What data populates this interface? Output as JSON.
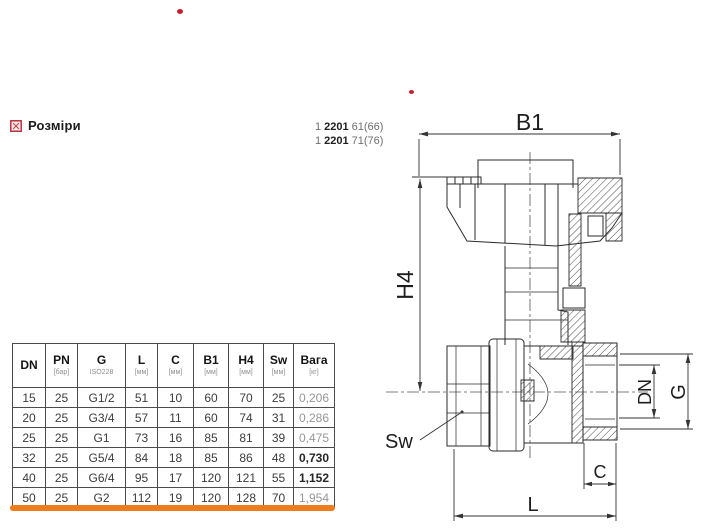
{
  "section_header": {
    "icon": "dimensions-checkbox-icon",
    "label": "Розміри"
  },
  "product_codes": [
    {
      "prefix": "1",
      "model": "2201",
      "variant": "61(66)"
    },
    {
      "prefix": "1",
      "model": "2201",
      "variant": "71(76)"
    }
  ],
  "drawing": {
    "labels": {
      "b1": "B1",
      "h4": "H4",
      "sw": "Sw",
      "dn": "DN",
      "g": "G",
      "c": "C",
      "l": "L"
    }
  },
  "table": {
    "columns": [
      {
        "label": "DN",
        "sub": ""
      },
      {
        "label": "PN",
        "sub": "[бар]"
      },
      {
        "label": "G",
        "sub": "ISO228"
      },
      {
        "label": "L",
        "sub": "[мм]"
      },
      {
        "label": "C",
        "sub": "[мм]"
      },
      {
        "label": "B1",
        "sub": "[мм]"
      },
      {
        "label": "H4",
        "sub": "[мм]"
      },
      {
        "label": "Sw",
        "sub": "[мм]"
      },
      {
        "label": "Вага",
        "sub": "[кг]"
      }
    ],
    "rows": [
      [
        "15",
        "25",
        "G1/2",
        "51",
        "10",
        "60",
        "70",
        "25",
        "0,206"
      ],
      [
        "20",
        "25",
        "G3/4",
        "57",
        "11",
        "60",
        "74",
        "31",
        "0,286"
      ],
      [
        "25",
        "25",
        "G1",
        "73",
        "16",
        "85",
        "81",
        "39",
        "0,475"
      ],
      [
        "32",
        "25",
        "G5/4",
        "84",
        "18",
        "85",
        "86",
        "48",
        "0,730"
      ],
      [
        "40",
        "25",
        "G6/4",
        "95",
        "17",
        "120",
        "121",
        "55",
        "1,152"
      ],
      [
        "50",
        "25",
        "G2",
        "112",
        "19",
        "120",
        "128",
        "70",
        "1,954"
      ]
    ],
    "weight_emphasis": [
      false,
      false,
      false,
      true,
      true,
      false
    ]
  },
  "colors": {
    "accent_orange": "#ee7d1e",
    "marker_red": "#c8202c",
    "checkbox_red": "#b5232d",
    "line": "#2b2b2b",
    "muted_text": "#8f8f8f"
  },
  "markers": [
    {
      "name": "red-dot-top"
    },
    {
      "name": "red-dot-mid"
    }
  ]
}
